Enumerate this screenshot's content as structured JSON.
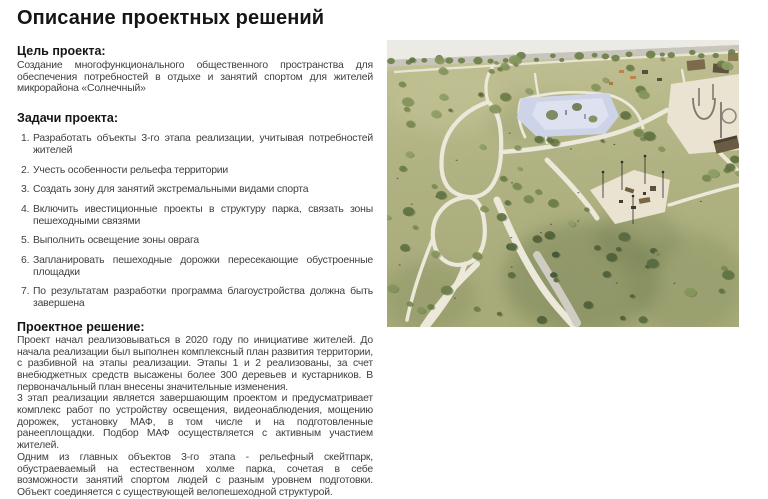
{
  "page": {
    "title": "Описание проектных решений"
  },
  "goal": {
    "heading": "Цель проекта:",
    "text": "Создание многофункционального общественного пространства для обеспечения потребностей в отдыхе и занятий спортом для жителей микрорайона «Солнечный»"
  },
  "tasks": {
    "heading": "Задачи проекта:",
    "items": [
      "Разработать объекты 3-го этапа реализации, учитывая потребностей жителей",
      "Учесть особенности рельефа территории",
      "Создать зону для занятий экстремальными видами спорта",
      "Включить ивестиционные проекты в структуру парка, связать зоны пешеходными связями",
      "Выполнить освещение зоны оврага",
      "Запланировать пешеходные дорожки пересекающие обустроенные площадки",
      "По результатам разработки программа благоустройства должна быть завершена"
    ]
  },
  "solution": {
    "heading": "Проектное решение:",
    "paragraphs": [
      "Проект начал реализовываться в 2020 году по инициативе жителей. До начала реализации был выполнен комплексный план развития территории, с разбивной на этапы реализации. Этапы 1 и 2 реализованы, за счет внебюджетных средств высажены более 300 деревьев и кустарников. В первоначальный план внесены значительные изменения.",
      "3 этап реализации является завершающим проектом и предусматривает комплекс работ по устройству освещения, видеонаблюдения, мощению дорожек, установку МАФ, в том числе и на подготовленные ранееплощадки. Подбор МАФ осуществляется с активным участием жителей.",
      "Одним из главных объектов 3-го этапа - рельефный скейтпарк, обустраеваемый на естественном холме парка, сочетая в себе возможности занятий спортом людей с разным уровнем подготовки. Объект соединяется с существующей велопешеходной структурой."
    ]
  },
  "render": {
    "colors": {
      "sky": "#eceae4",
      "road": "#c8c5bc",
      "grass": "#b1b383",
      "path": "#ece8da",
      "path_gray": "#cfccc2",
      "pond": "#cdd4e8",
      "plaza": "#eae3d1",
      "tree": "#7a8a52",
      "shadow": "#5a6a3e"
    }
  }
}
